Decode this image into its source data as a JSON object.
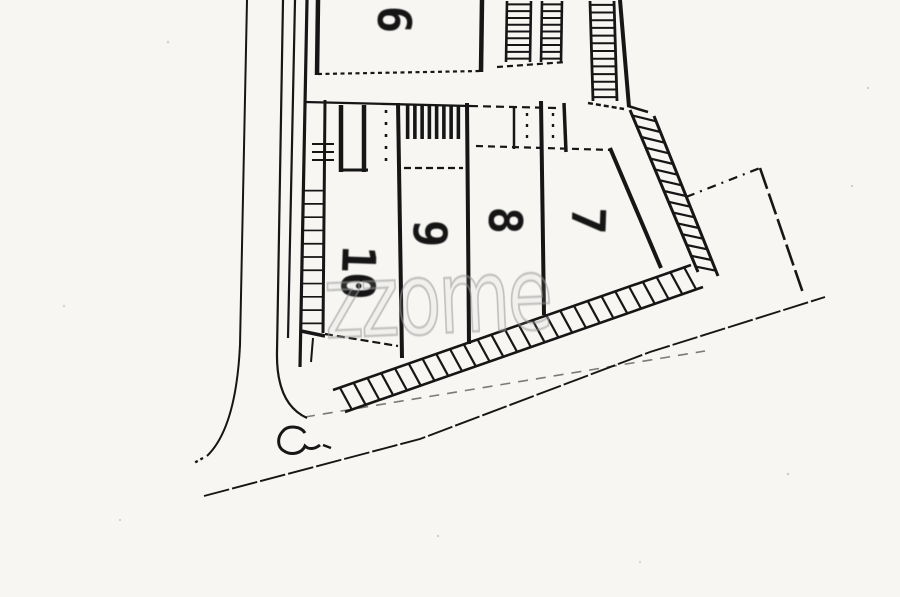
{
  "document": {
    "kind": "scanned site plan",
    "background_color": "#f7f6f3",
    "ink_color": "#161616"
  },
  "plots": [
    {
      "id": "plot-6",
      "label": "6"
    },
    {
      "id": "plot-10",
      "label": "10"
    },
    {
      "id": "plot-9",
      "label": "9"
    },
    {
      "id": "plot-8",
      "label": "8"
    },
    {
      "id": "plot-7",
      "label": "7"
    }
  ],
  "watermark": {
    "text": "zzome",
    "color": "#a8a8a8"
  }
}
